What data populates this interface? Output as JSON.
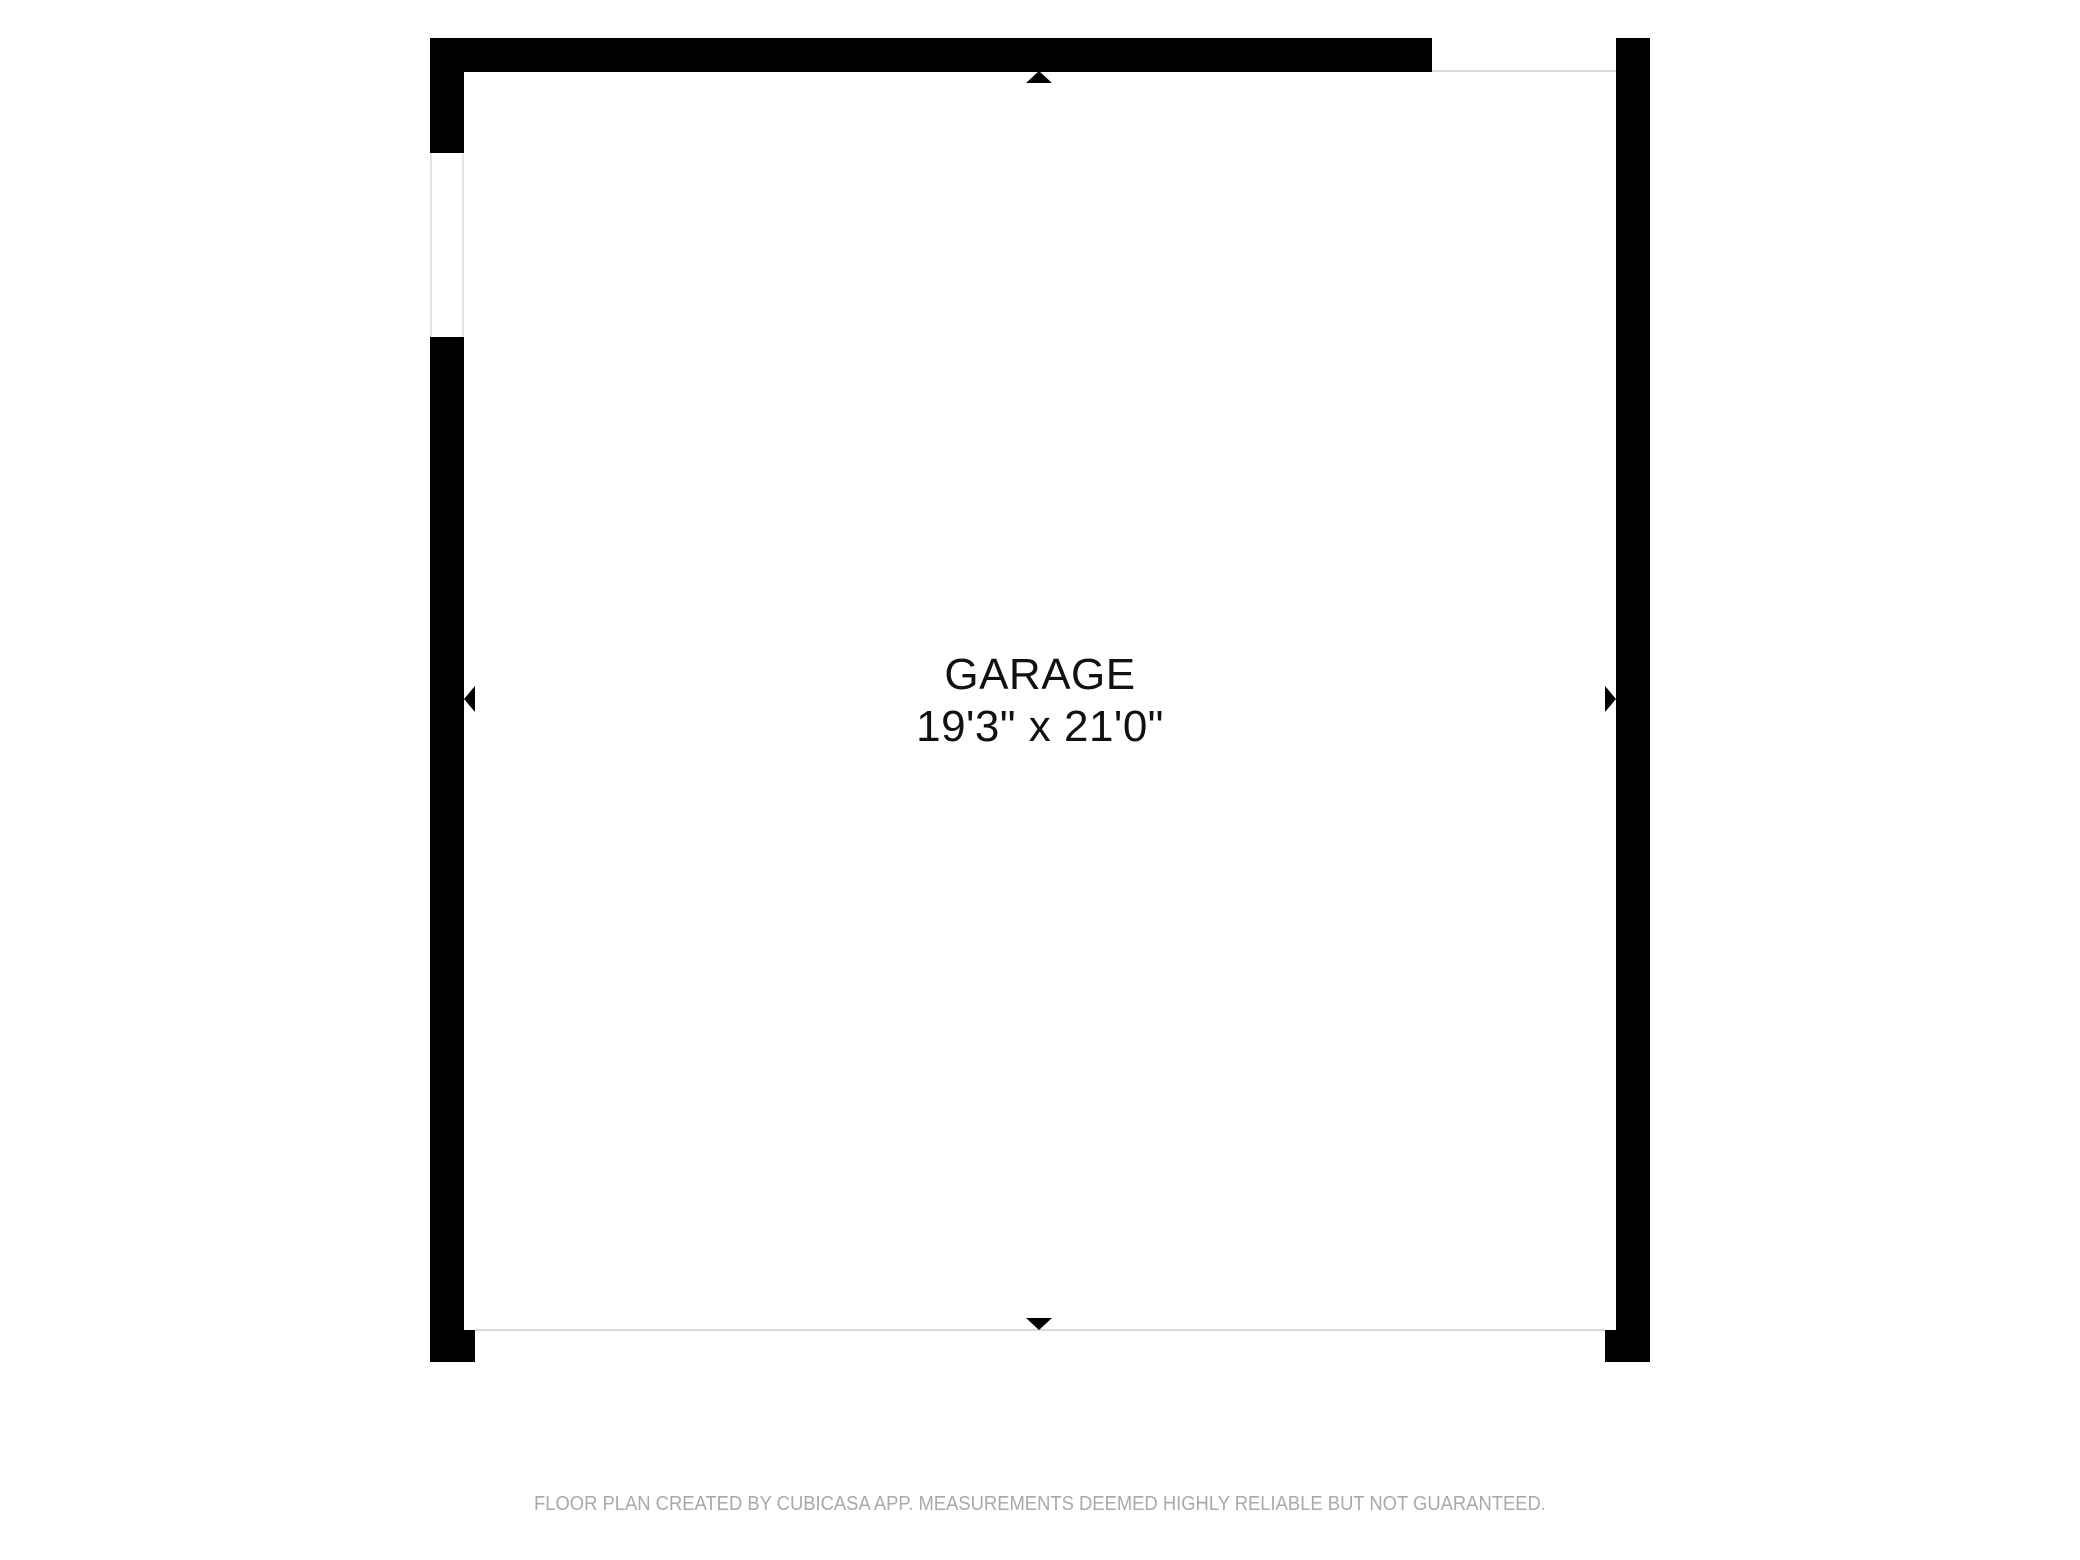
{
  "room": {
    "name": "GARAGE",
    "dimensions": "19'3\" x 21'0\""
  },
  "footer": {
    "disclaimer": "FLOOR PLAN CREATED BY CUBICASA APP. MEASUREMENTS DEEMED HIGHLY RELIABLE BUT NOT GUARANTEED."
  },
  "colors": {
    "wall": "#000000",
    "background": "#ffffff",
    "room_text": "#111111",
    "footer_text": "#a9a9a9",
    "door_line": "#d9d9d9",
    "window_line": "#e4e4e4"
  }
}
